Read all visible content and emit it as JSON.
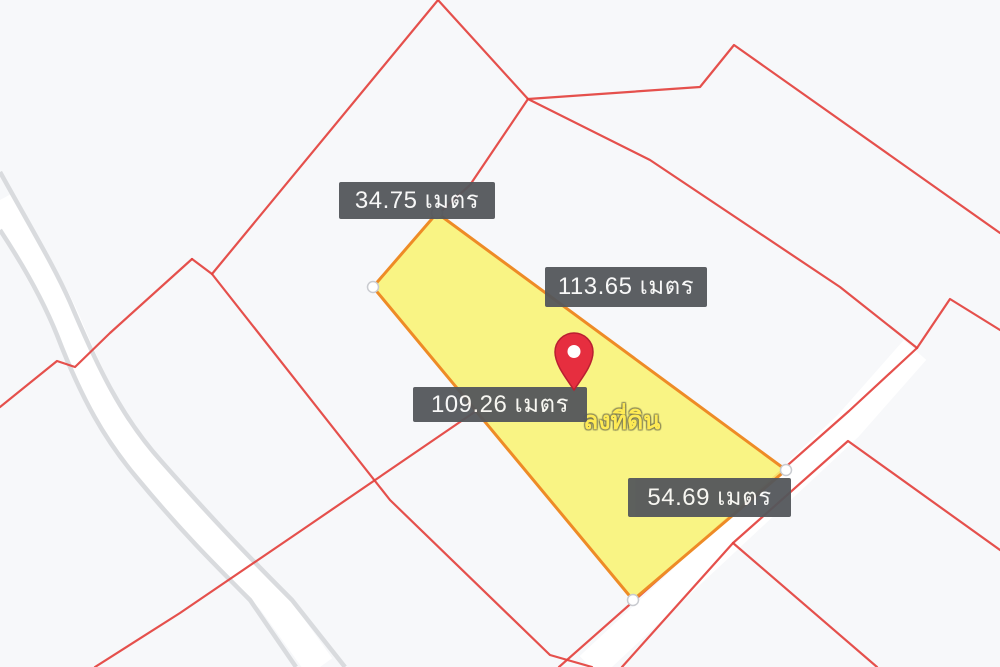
{
  "map": {
    "description": "Cadastral map view with highlighted land parcel and side-length measurements",
    "measurement_labels": [
      {
        "text": "34.75 เมตร",
        "value": 34.75,
        "unit": "เมตร",
        "edge": "top-left"
      },
      {
        "text": "113.65 เมตร",
        "value": 113.65,
        "unit": "เมตร",
        "edge": "top-right"
      },
      {
        "text": "109.26 เมตร",
        "value": 109.26,
        "unit": "เมตร",
        "edge": "bottom-left"
      },
      {
        "text": "54.69 เมตร",
        "value": 54.69,
        "unit": "เมตร",
        "edge": "bottom-right"
      }
    ],
    "watermark_fragment": "ลงที่ดิน",
    "colors": {
      "background": "#f7f8fa",
      "boundary_red": "#e3413d",
      "road_gray": "#d9dbde",
      "parcel_fill": "#f9f273",
      "parcel_border": "#ee8b26",
      "label_bg": "#54575b",
      "label_text": "#f7f7f7",
      "pin_red": "#e62e3f",
      "pin_dark": "#ba1f31",
      "watermark_yellow": "#ffe94d",
      "marker_fill": "#ffffff",
      "marker_stroke": "#c9cbd0"
    }
  }
}
